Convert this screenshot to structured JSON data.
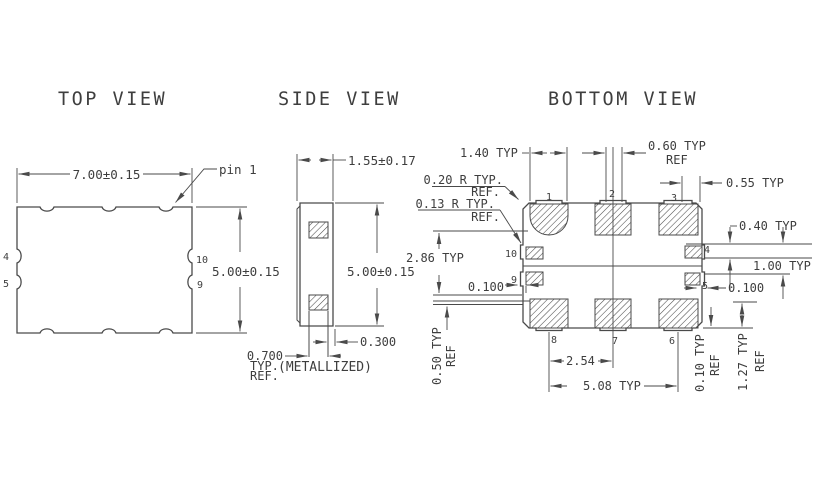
{
  "page": {
    "background": "#ffffff",
    "line_color": "#4a4a4a",
    "text_color": "#3e3e3e"
  },
  "views": {
    "top": {
      "title": "TOP VIEW",
      "dim_body_width": "7.00±0.15",
      "dim_body_height": "5.00±0.15",
      "pin1_callout": "pin 1",
      "pin_labels": {
        "p4": "4",
        "p5": "5",
        "p9": "9",
        "p10": "10"
      }
    },
    "side": {
      "title": "SIDE VIEW",
      "dim_thickness": "1.55±0.17",
      "dim_body_height": "5.00±0.15",
      "dim_pad_inset": "0.300",
      "dim_pad_width": "0.700",
      "dim_pad_width_line2": "TYP.",
      "dim_pad_width_line3": "REF.",
      "metallized_note": "(METALLIZED)"
    },
    "bottom": {
      "title": "BOTTOM VIEW",
      "dim_pad_width": "1.40 TYP",
      "dim_notch_width": "0.60 TYP",
      "dim_notch_width_ref": "REF",
      "dim_corner_pad": "0.55 TYP",
      "radius_callout_1": "0.20 R TYP.",
      "radius_callout_1_ref": "REF.",
      "radius_callout_2": "0.13 R TYP.",
      "radius_callout_2_ref": "REF.",
      "dim_side_pad_height": "0.40 TYP",
      "dim_side_pad_pitch": "1.00 TYP",
      "dim_rows_span": "2.86 TYP",
      "dim_edge_gap_left": "0.100",
      "dim_edge_gap_right": "0.100",
      "dim_pad_pitch": "2.54",
      "dim_pads_span": "5.08 TYP",
      "dim_left_offset": "0.50 TYP",
      "dim_left_offset_ref": "REF",
      "dim_right_offset_1": "0.10 TYP",
      "dim_right_offset_1_ref": "REF",
      "dim_right_offset_2": "1.27 TYP",
      "dim_right_offset_2_ref": "REF",
      "pin_labels": {
        "p1": "1",
        "p2": "2",
        "p3": "3",
        "p4": "4",
        "p5": "5",
        "p6": "6",
        "p7": "7",
        "p8": "8",
        "p9": "9",
        "p10": "10"
      }
    }
  }
}
